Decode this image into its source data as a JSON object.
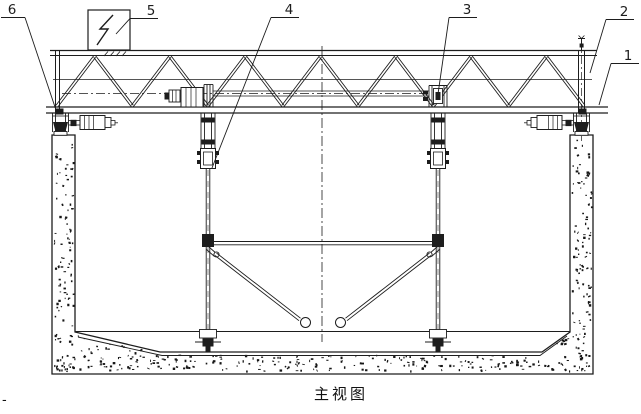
{
  "drawing": {
    "caption": "主视图",
    "corner_mark": "-",
    "part_labels": [
      {
        "id": "1"
      },
      {
        "id": "2"
      },
      {
        "id": "3"
      },
      {
        "id": "4"
      },
      {
        "id": "5"
      },
      {
        "id": "6"
      }
    ],
    "symbols": {
      "electric_box": "lightning-bolt-symbol"
    },
    "colors": {
      "line": "#1d1d1d",
      "background": "#ffffff",
      "concrete_dot": "#161616"
    }
  }
}
